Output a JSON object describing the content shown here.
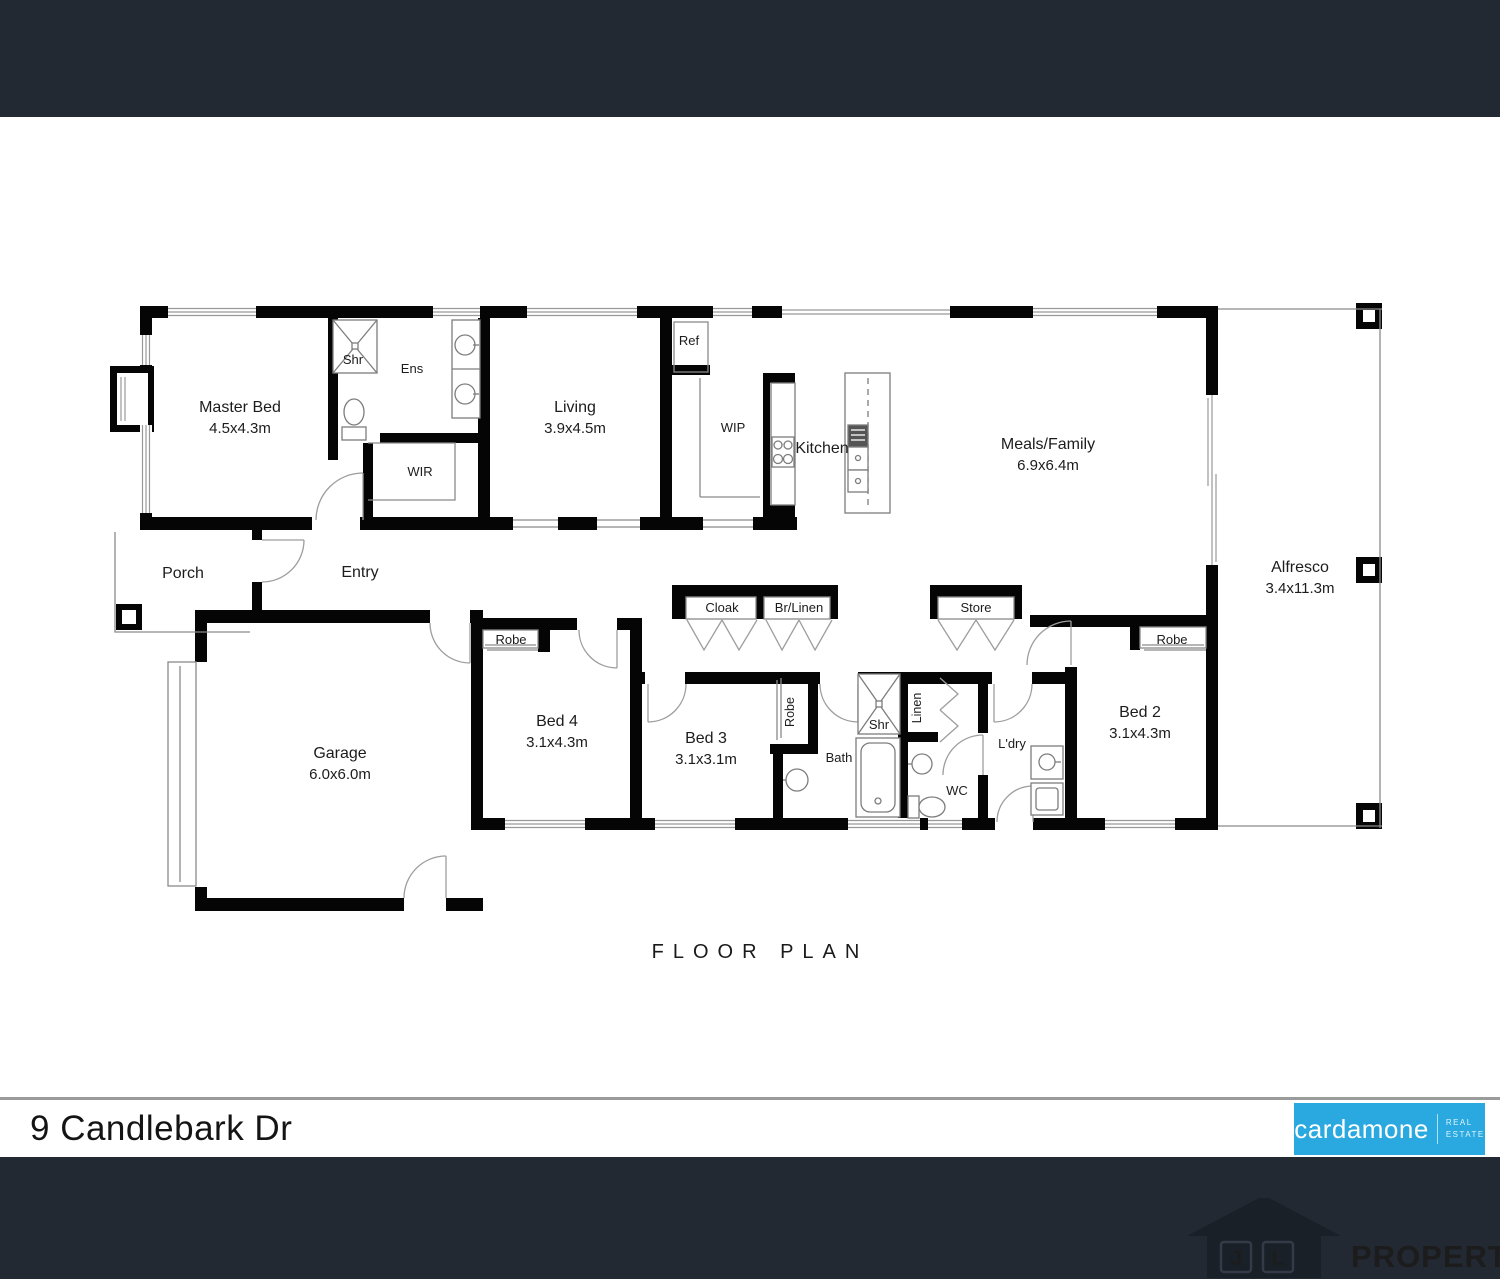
{
  "plan": {
    "caption": "FLOOR PLAN",
    "rooms": {
      "master": {
        "name": "Master Bed",
        "dims": "4.5x4.3m"
      },
      "living": {
        "name": "Living",
        "dims": "3.9x4.5m"
      },
      "meals": {
        "name": "Meals/Family",
        "dims": "6.9x6.4m"
      },
      "alfresco": {
        "name": "Alfresco",
        "dims": "3.4x11.3m"
      },
      "garage": {
        "name": "Garage",
        "dims": "6.0x6.0m"
      },
      "bed2": {
        "name": "Bed 2",
        "dims": "3.1x4.3m"
      },
      "bed3": {
        "name": "Bed 3",
        "dims": "3.1x3.1m"
      },
      "bed4": {
        "name": "Bed 4",
        "dims": "3.1x4.3m"
      }
    },
    "labels": {
      "porch": "Porch",
      "entry": "Entry",
      "shr": "Shr",
      "ens": "Ens",
      "wir": "WIR",
      "ref": "Ref",
      "wip": "WIP",
      "kitchen": "Kitchen",
      "robe": "Robe",
      "cloak": "Cloak",
      "br_linen": "Br/Linen",
      "store": "Store",
      "linen": "Linen",
      "bath": "Bath",
      "wc": "WC",
      "ldry": "L'dry"
    }
  },
  "address_bar": {
    "address": "9 Candlebark Dr"
  },
  "brand": {
    "name": "cardamone",
    "tagline_top": "REAL",
    "tagline_bottom": "ESTATE",
    "color": "#29A9E0"
  },
  "watermark": {
    "letter1": "J",
    "letter2": "L",
    "text": "PROPERTY"
  },
  "colors": {
    "background": "#222933",
    "walls": "#050505",
    "divider": "#9b9b9b"
  }
}
